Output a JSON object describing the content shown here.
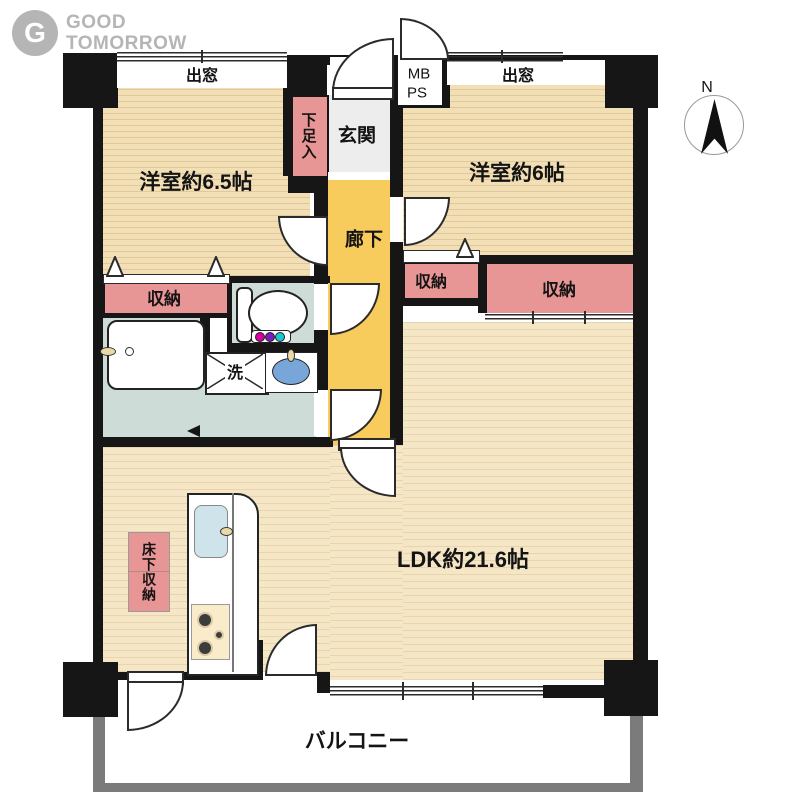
{
  "logo": {
    "icon_letter": "G",
    "line1": "GOOD",
    "line2": "TOMORROW"
  },
  "compass": {
    "north": "N"
  },
  "rooms": {
    "bedroom1": "洋室約6.5帖",
    "bedroom2": "洋室約6帖",
    "ldk": "LDK約21.6帖",
    "corridor": "廊下",
    "entrance": "玄関",
    "shoe_storage": "下足入",
    "closet1": "収納",
    "closet2": "収納",
    "closet3": "収納",
    "underfloor_storage": "床下収納",
    "balcony": "バルコニー",
    "washer": "洗",
    "bay_window_left": "出窓",
    "bay_window_right": "出窓",
    "mb": "MB",
    "ps": "PS"
  },
  "colors": {
    "wood_floor": "#f2dfb6",
    "ldk_floor": "#f5e7c6",
    "closet_pink": "#e89595",
    "corridor_yellow": "#f8cc5c",
    "entrance_gray": "#ededed",
    "wet_area": "#cddcd7",
    "wall_black": "#161616",
    "balcony_gray": "#7b7b7b",
    "basin_blue": "#79a6d9",
    "logo_gray": "#b5b5b5"
  }
}
